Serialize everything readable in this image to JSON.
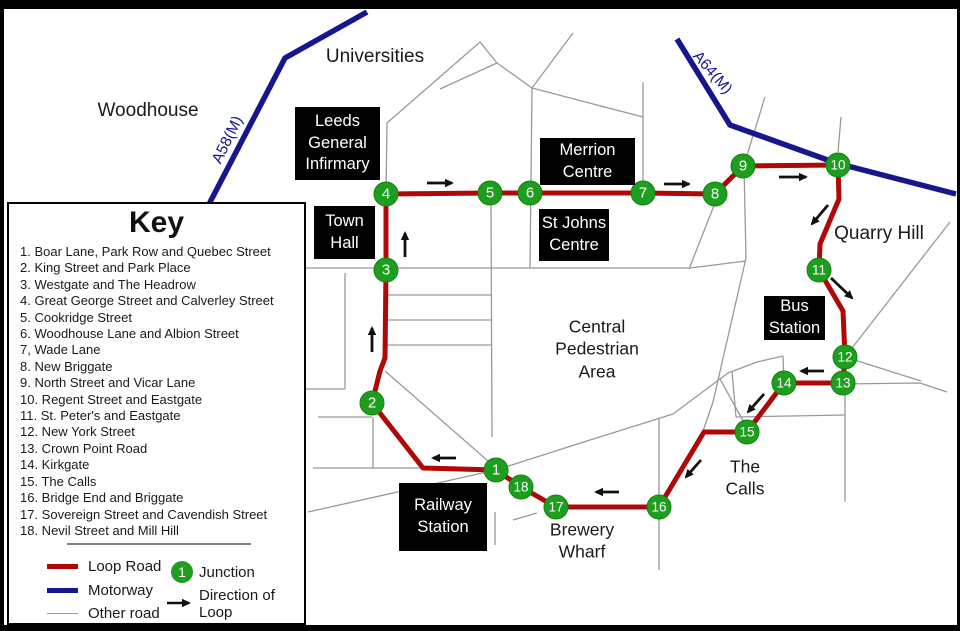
{
  "colors": {
    "loop": "#b00808",
    "motorway": "#16168e",
    "other": "#999999",
    "arrow": "#111111",
    "junction_fill": "#1e9e1e",
    "junction_edge": "#128312",
    "junction_text": "#ffffff",
    "box_bg": "#000000",
    "box_text": "#ffffff"
  },
  "key": {
    "title": "Key",
    "items": [
      "1. Boar Lane, Park Row and Quebec Street",
      "2. King Street and Park Place",
      "3. Westgate and The Headrow",
      "4. Great George Street and Calverley Street",
      "5. Cookridge Street",
      "6. Woodhouse Lane and Albion Street",
      "7, Wade Lane",
      "8. New Briggate",
      "9. North Street and Vicar Lane",
      "10. Regent Street and Eastgate",
      "11. St. Peter's and Eastgate",
      "12. New York Street",
      "13. Crown Point Road",
      "14. Kirkgate",
      "15. The Calls",
      "16. Bridge End and Briggate",
      "17. Sovereign Street and Cavendish Street",
      "18. Nevil Street and Mill Hill"
    ],
    "legend": {
      "loop": "Loop Road",
      "motorway": "Motorway",
      "other": "Other road",
      "junction_sample": "1",
      "junction": "Junction",
      "direction_line1": "Direction of",
      "direction_line2": "Loop"
    }
  },
  "map": {
    "area_labels": [
      {
        "name": "woodhouse-label",
        "lines": [
          "Woodhouse"
        ],
        "x": 148,
        "y": 111,
        "size": 19
      },
      {
        "name": "universities-label",
        "lines": [
          "Universities"
        ],
        "x": 375,
        "y": 57,
        "size": 19
      },
      {
        "name": "quarry-hill-label",
        "lines": [
          "Quarry Hill"
        ],
        "x": 879,
        "y": 234,
        "size": 19
      },
      {
        "name": "central-pedestrian-area-label",
        "lines": [
          "Central",
          "Pedestrian",
          "Area"
        ],
        "x": 597,
        "y": 349,
        "size": 17.5
      },
      {
        "name": "the-calls-label",
        "lines": [
          "The",
          "Calls"
        ],
        "x": 745,
        "y": 478,
        "size": 17.5
      },
      {
        "name": "brewery-wharf-label",
        "lines": [
          "Brewery",
          "Wharf"
        ],
        "x": 582,
        "y": 541,
        "size": 17.5
      },
      {
        "name": "a58m-motorway-label",
        "lines": [
          "A58(M)"
        ],
        "x": 228,
        "y": 140,
        "size": 15.5,
        "rotate": -64,
        "color": "#16168e"
      },
      {
        "name": "a64m-motorway-label",
        "lines": [
          "A64(M)"
        ],
        "x": 712,
        "y": 73,
        "size": 15.5,
        "rotate": 49,
        "color": "#16168e"
      }
    ],
    "place_boxes": [
      {
        "name": "leeds-general-infirmary-box",
        "lines": [
          "Leeds",
          "General",
          "Infirmary"
        ],
        "x": 295,
        "y": 107,
        "w": 85,
        "h": 73
      },
      {
        "name": "town-hall-box",
        "lines": [
          "Town",
          "Hall"
        ],
        "x": 314,
        "y": 206,
        "w": 61,
        "h": 53
      },
      {
        "name": "merrion-centre-box",
        "lines": [
          "Merrion",
          "Centre"
        ],
        "x": 540,
        "y": 138,
        "w": 95,
        "h": 47
      },
      {
        "name": "st-johns-centre-box",
        "lines": [
          "St Johns",
          "Centre"
        ],
        "x": 539,
        "y": 209,
        "w": 70,
        "h": 52
      },
      {
        "name": "bus-station-box",
        "lines": [
          "Bus",
          "Station"
        ],
        "x": 764,
        "y": 296,
        "w": 61,
        "h": 44
      },
      {
        "name": "railway-station-box",
        "lines": [
          "Railway",
          "Station"
        ],
        "x": 399,
        "y": 483,
        "w": 88,
        "h": 68
      }
    ],
    "junctions": [
      {
        "n": "1",
        "x": 496,
        "y": 470
      },
      {
        "n": "2",
        "x": 372,
        "y": 403
      },
      {
        "n": "3",
        "x": 386,
        "y": 270
      },
      {
        "n": "4",
        "x": 386,
        "y": 194
      },
      {
        "n": "5",
        "x": 490,
        "y": 193
      },
      {
        "n": "6",
        "x": 530,
        "y": 193
      },
      {
        "n": "7",
        "x": 643,
        "y": 193
      },
      {
        "n": "8",
        "x": 715,
        "y": 194
      },
      {
        "n": "9",
        "x": 743,
        "y": 166
      },
      {
        "n": "10",
        "x": 838,
        "y": 165
      },
      {
        "n": "11",
        "x": 819,
        "y": 270
      },
      {
        "n": "12",
        "x": 845,
        "y": 357
      },
      {
        "n": "13",
        "x": 843,
        "y": 383
      },
      {
        "n": "14",
        "x": 784,
        "y": 383
      },
      {
        "n": "15",
        "x": 747,
        "y": 432
      },
      {
        "n": "16",
        "x": 659,
        "y": 507
      },
      {
        "n": "17",
        "x": 556,
        "y": 507
      },
      {
        "n": "18",
        "x": 521,
        "y": 487
      }
    ],
    "roads": {
      "loop": "386,194 490,193 530,193 643,193 715,194 743,166 838,165 839,199 820,244 819,270 843,311 845,357 843,383 784,383 747,432 704,432 659,507 556,507 521,487 496,470 423,468 372,403 380,371 385,358 386,270 386,194",
      "motorways": [
        "367,12 285,58 207,208",
        "677,39 730,125 836,163 956,194"
      ],
      "other": [
        "440,89 497,63",
        "387,123 480,42 497,63",
        "497,63 532,88",
        "573,33 532,88",
        "532,88 530,268",
        "532,88 643,117",
        "643,82 643,193",
        "387,123 386,194",
        "303,268 690,268 746,261",
        "386,295 491,295",
        "387,320 491,320",
        "387,345 491,345",
        "491,203 492,437",
        "345,273 345,389",
        "303,389 345,389",
        "318,417 372,417",
        "373,417 373,468",
        "313,468 423,468",
        "385,371 496,468",
        "308,512 496,470",
        "496,470 590,440 673,414 728,373 757,362 783,356",
        "783,356 784,382",
        "732,371 736,417",
        "736,417 845,415",
        "845,383 845,502",
        "845,357 921,381",
        "843,384 920,383 947,392",
        "950,222 845,357",
        "765,97 744,165",
        "744,166 746,258 713,402 701,437",
        "841,117 838,152",
        "715,203 689,269",
        "720,379 746,426",
        "659,418 659,570",
        "513,520 537,513",
        "495,512 495,545"
      ]
    },
    "arrows": [
      {
        "x1": 427,
        "y1": 183,
        "x2": 452,
        "y2": 183
      },
      {
        "x1": 664,
        "y1": 184,
        "x2": 689,
        "y2": 184
      },
      {
        "x1": 779,
        "y1": 177,
        "x2": 806,
        "y2": 177
      },
      {
        "x1": 828,
        "y1": 205,
        "x2": 812,
        "y2": 224
      },
      {
        "x1": 831,
        "y1": 278,
        "x2": 852,
        "y2": 298
      },
      {
        "x1": 824,
        "y1": 371,
        "x2": 801,
        "y2": 371
      },
      {
        "x1": 764,
        "y1": 394,
        "x2": 748,
        "y2": 412
      },
      {
        "x1": 701,
        "y1": 460,
        "x2": 686,
        "y2": 477
      },
      {
        "x1": 619,
        "y1": 492,
        "x2": 596,
        "y2": 492
      },
      {
        "x1": 456,
        "y1": 458,
        "x2": 433,
        "y2": 458
      },
      {
        "x1": 372,
        "y1": 352,
        "x2": 372,
        "y2": 328
      },
      {
        "x1": 405,
        "y1": 257,
        "x2": 405,
        "y2": 233
      }
    ]
  }
}
